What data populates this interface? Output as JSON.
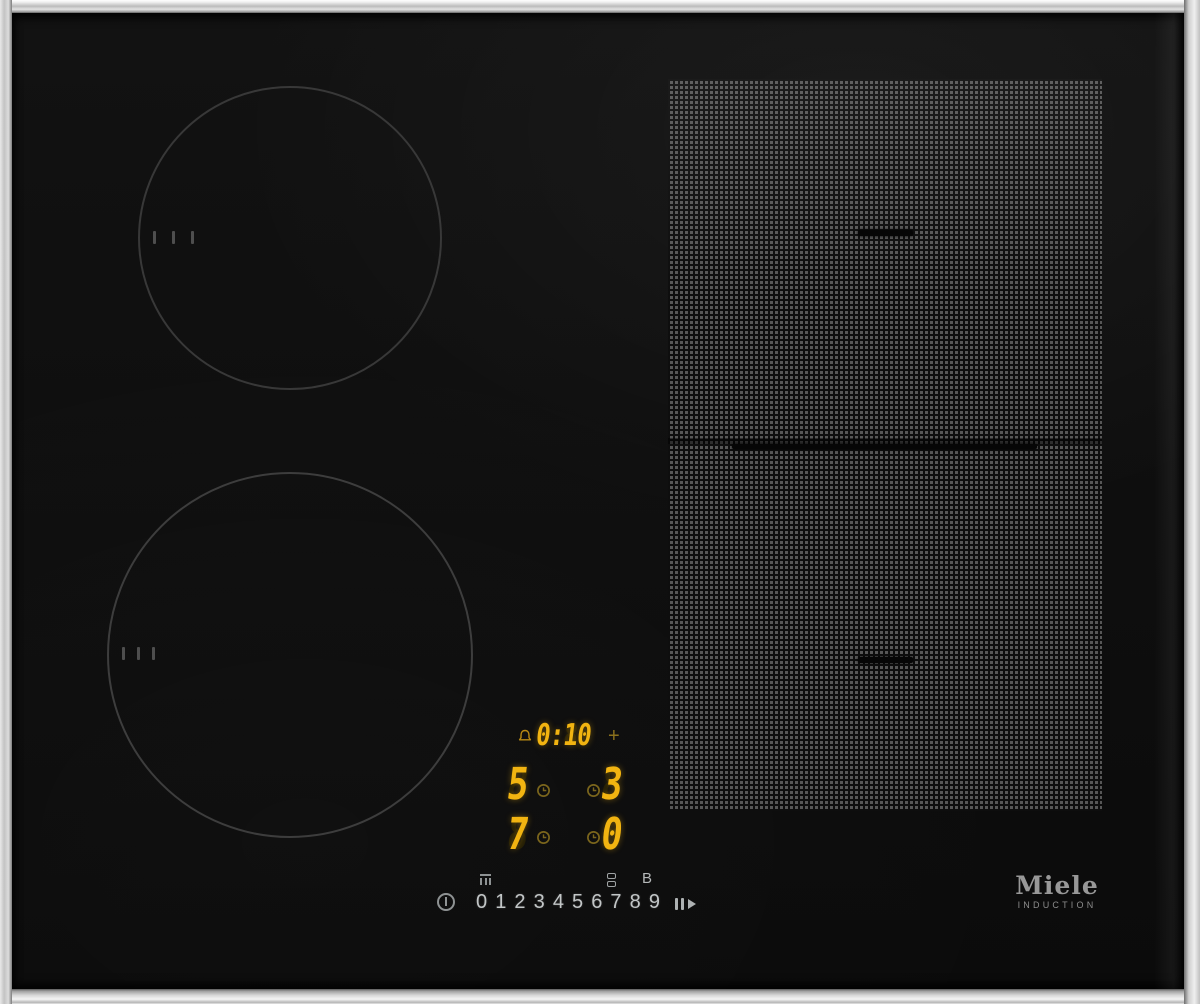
{
  "brand": {
    "name": "Miele",
    "tagline": "INDUCTION"
  },
  "timer_display": {
    "value": "0:10",
    "ghost": "8:88",
    "plus_label": "+"
  },
  "power_displays": [
    {
      "zone": "rear-left-zone",
      "level": "5",
      "ghost": "8"
    },
    {
      "zone": "rear-flex-zone",
      "level": "3",
      "ghost": "8"
    },
    {
      "zone": "front-left-zone",
      "level": "7",
      "ghost": "8"
    },
    {
      "zone": "front-flex-zone",
      "level": "0",
      "ghost": "8"
    }
  ],
  "controls": {
    "digits": [
      "0",
      "1",
      "2",
      "3",
      "4",
      "5",
      "6",
      "7",
      "8",
      "9"
    ],
    "booster_label": "B",
    "icons": [
      "power-icon",
      "keep-warm-icon",
      "bridge-zones-icon",
      "booster-key",
      "stop-and-go-icon",
      "timer-bell-icon",
      "zone-timer-clock-icon",
      "plus-key"
    ]
  },
  "colors": {
    "segment_lit": "#f2b411",
    "segment_dim": "#8a701c",
    "segment_ghost": "#241e06",
    "glass": "#0e0e0e",
    "frame_metal": "#c9c9c9",
    "control_text": "#c2c6c7",
    "zone_ring": "#383838",
    "flex_dot": "#575757",
    "logo_gray": "#989898"
  }
}
